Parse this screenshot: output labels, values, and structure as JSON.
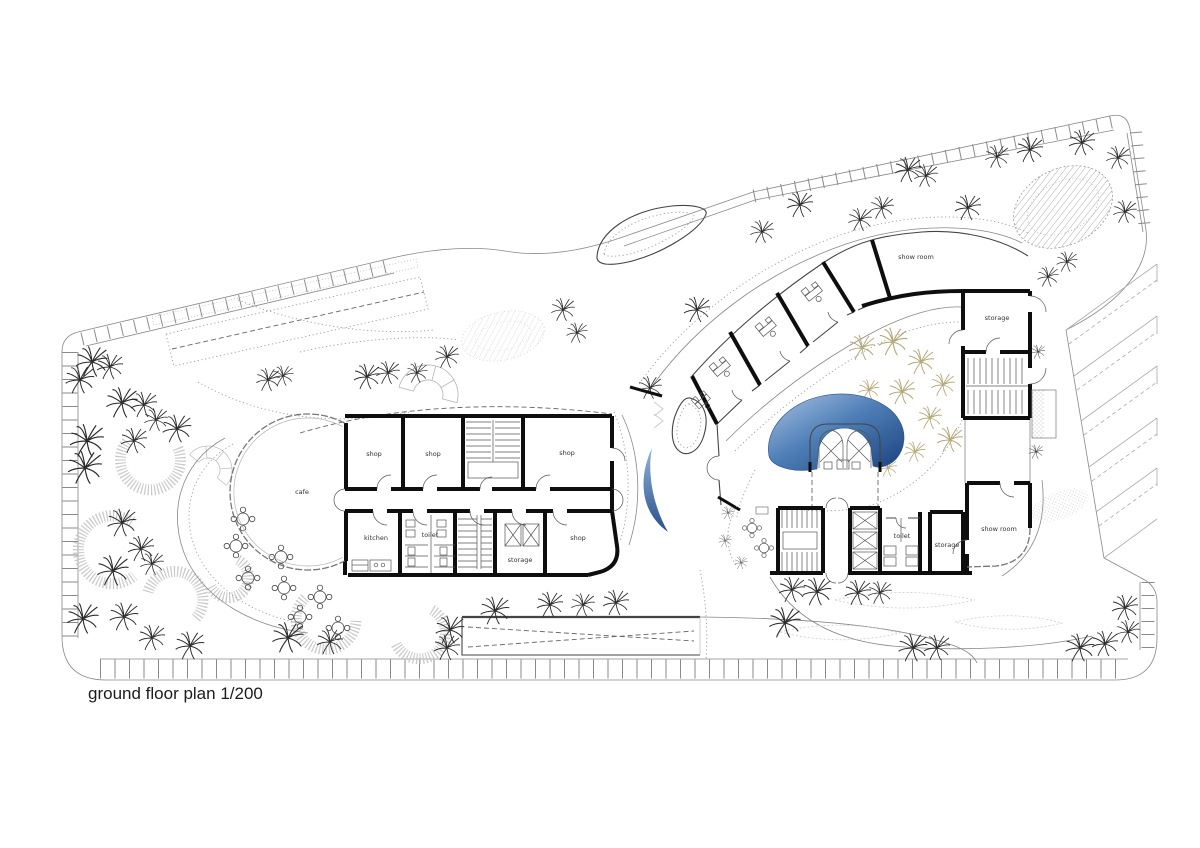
{
  "title": "ground floor plan 1/200",
  "plan": {
    "name": "ground floor plan",
    "scale": "1/200"
  },
  "rooms": {
    "left_building": [
      "cafe",
      "shop",
      "shop",
      "shop",
      "kitchen",
      "toilet",
      "storage",
      "shop"
    ],
    "right_building": [
      "show room",
      "storage",
      "toilet",
      "storage",
      "show room"
    ]
  },
  "colors": {
    "paper": "#ffffff",
    "ink": "#1c1c1c",
    "wall": "#0e0e0e",
    "pool_light": "#aac3e3",
    "pool_mid": "#5080b8",
    "pool_dark": "#1a417d",
    "water_light": "#93b3da",
    "water_dark": "#27508b",
    "courtyard_tree": "#b3a776",
    "hatch": "#9a9a9a"
  },
  "icons": {
    "tree": "palm-tree-icon",
    "table": "round-table-icon",
    "desk": "desk-icon",
    "elevator": "elevator-icon",
    "panorama_lift": "panoramic-elevator-icon",
    "stairs": "staircase-icon",
    "pool": "pool-icon",
    "water": "water-feature-icon"
  }
}
